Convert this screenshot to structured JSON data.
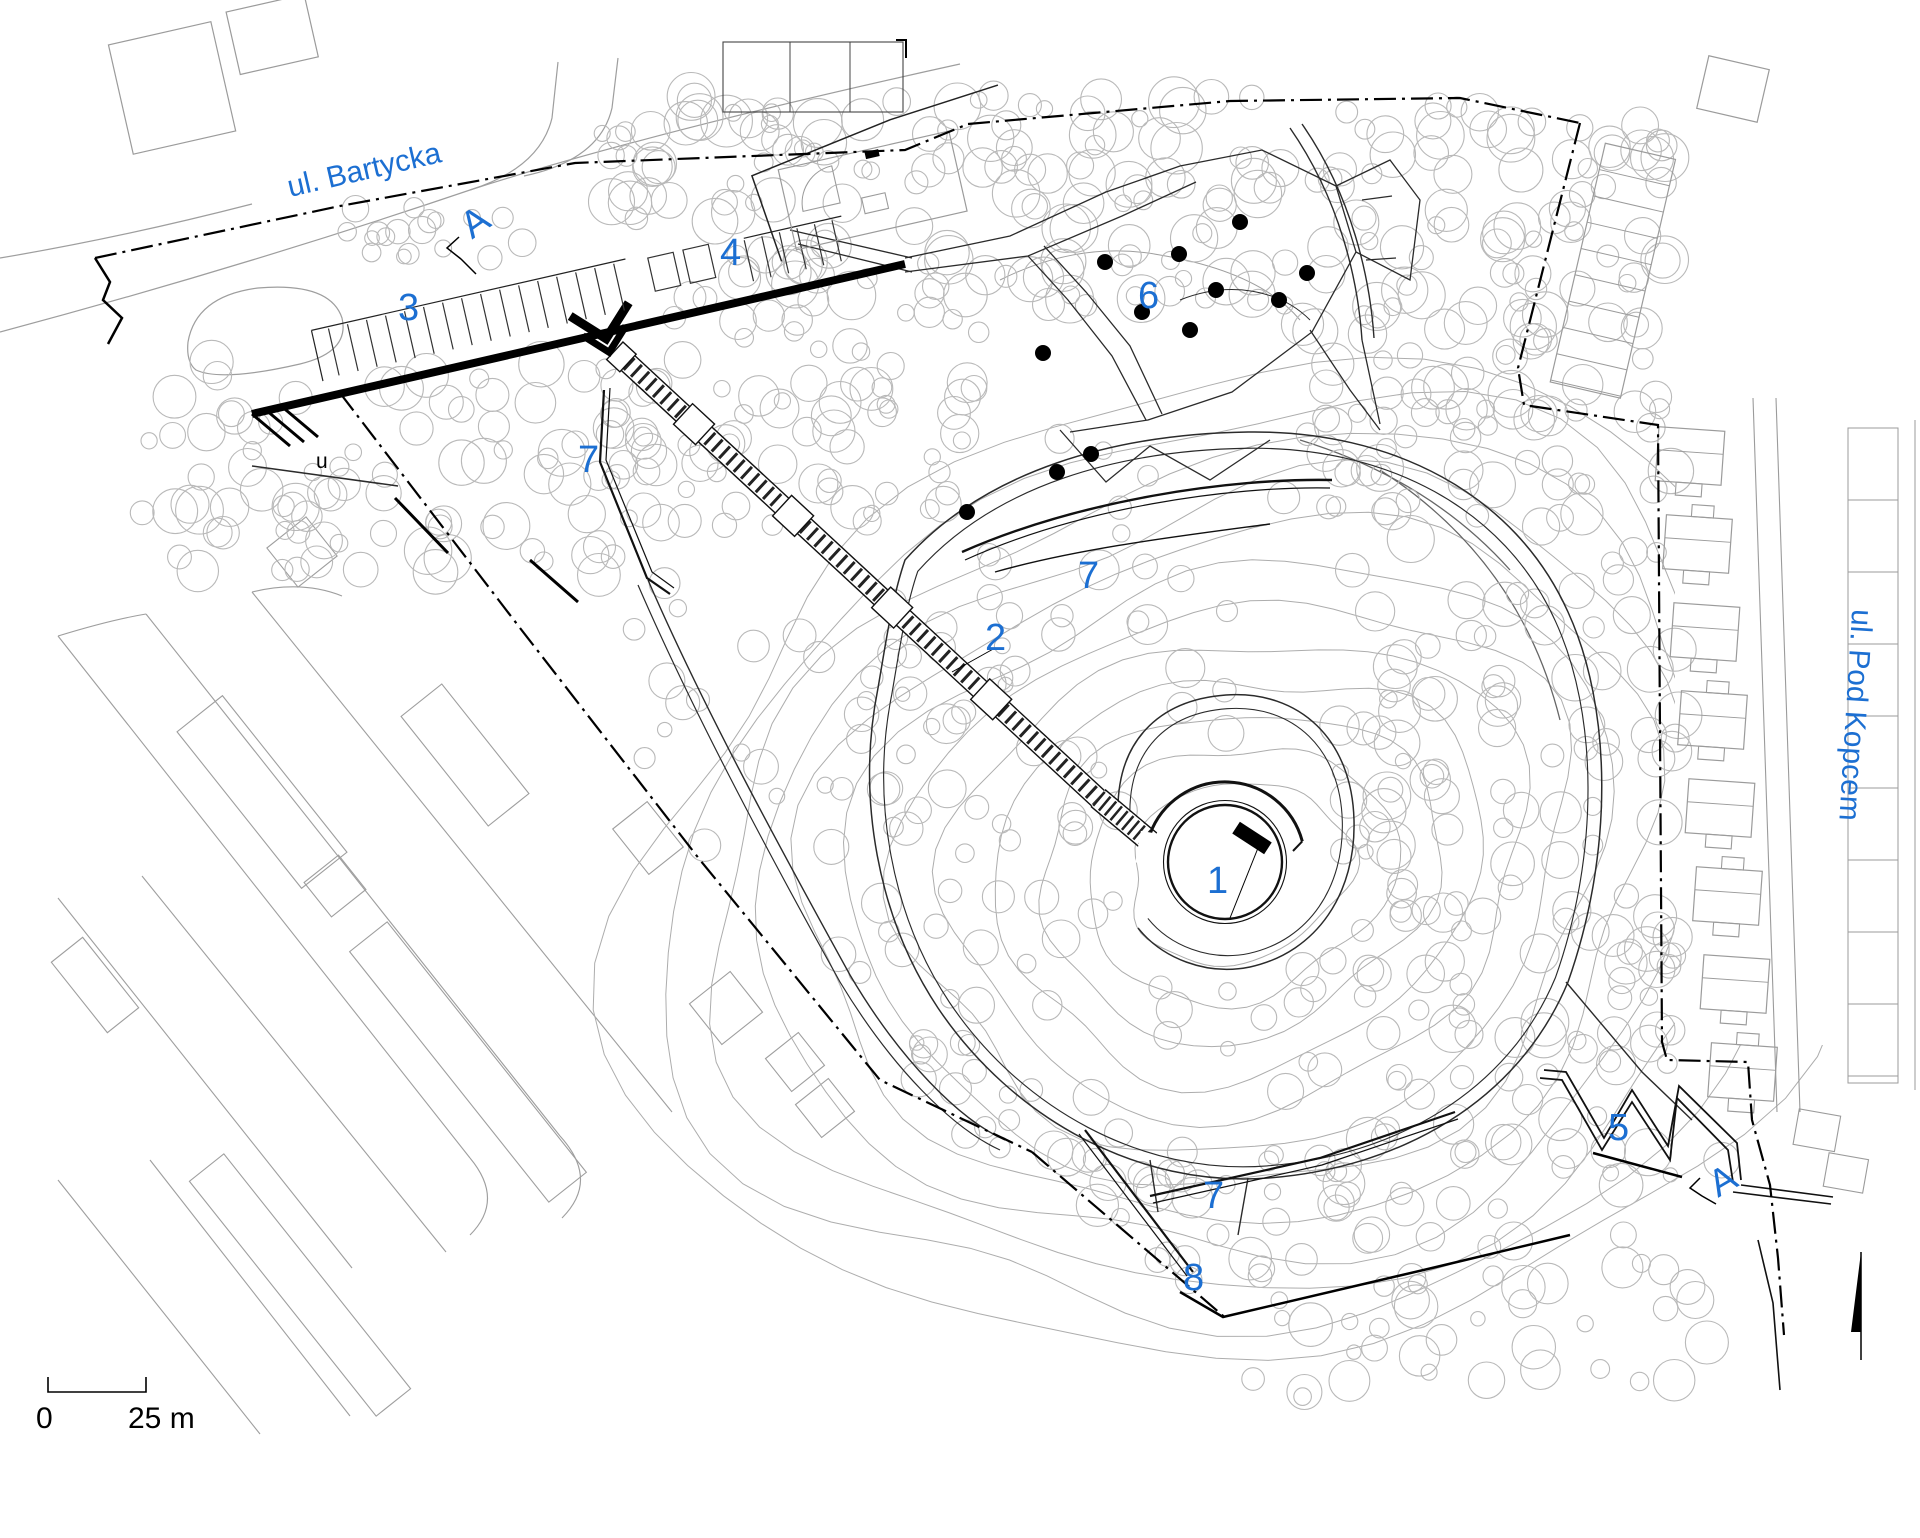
{
  "labels": {
    "street_bartycka": "ul. Bartycka",
    "street_pod_kopcem": "ul. Pod Kopcem",
    "n1": "1",
    "n2": "2",
    "n3": "3",
    "n4": "4",
    "n5": "5",
    "n6": "6",
    "n7": "7",
    "n8": "8",
    "section_a": "A",
    "scale_zero": "0",
    "scale_distance": "25 m",
    "tiny_u": "u"
  },
  "colors": {
    "label_blue": "#1c6fd2",
    "ink_black": "#000000",
    "path_dark": "#2b2b2b",
    "wall_dark": "#111111",
    "contour_gray": "#adadad",
    "tree_gray": "#b9b9b9",
    "street_gray": "#9e9e9e",
    "building_gray": "#9b9b9b",
    "background": "#ffffff"
  }
}
